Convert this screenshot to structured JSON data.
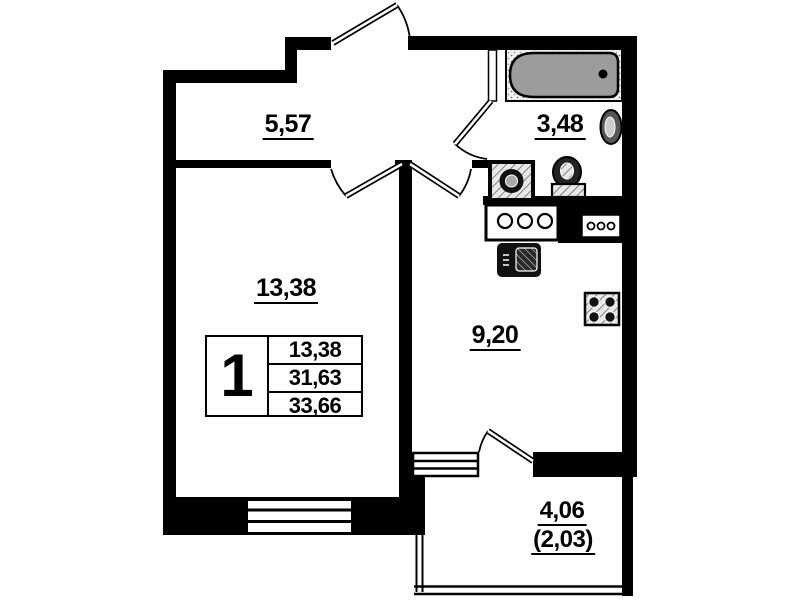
{
  "floor_plan": {
    "room_labels": {
      "hallway": "5,57",
      "bathroom": "3,48",
      "living_room": "13,38",
      "kitchen": "9,20",
      "balcony_total": "4,06",
      "balcony_reduced": "(2,03)"
    },
    "info_box": {
      "room_count": "1",
      "rows": [
        "13,38",
        "31,63",
        "33,66"
      ]
    },
    "colors": {
      "wall": "#000000",
      "background": "#ffffff",
      "bathtub_fill": "#9c9c9c"
    },
    "fixture_icons": [
      "bathtub-icon",
      "wash-basin-icon",
      "toilet-icon",
      "washing-machine-icon",
      "kitchen-counter-icon",
      "kitchen-sink-icon",
      "cooktop-icon",
      "window-icon",
      "door-swing-icon"
    ]
  }
}
